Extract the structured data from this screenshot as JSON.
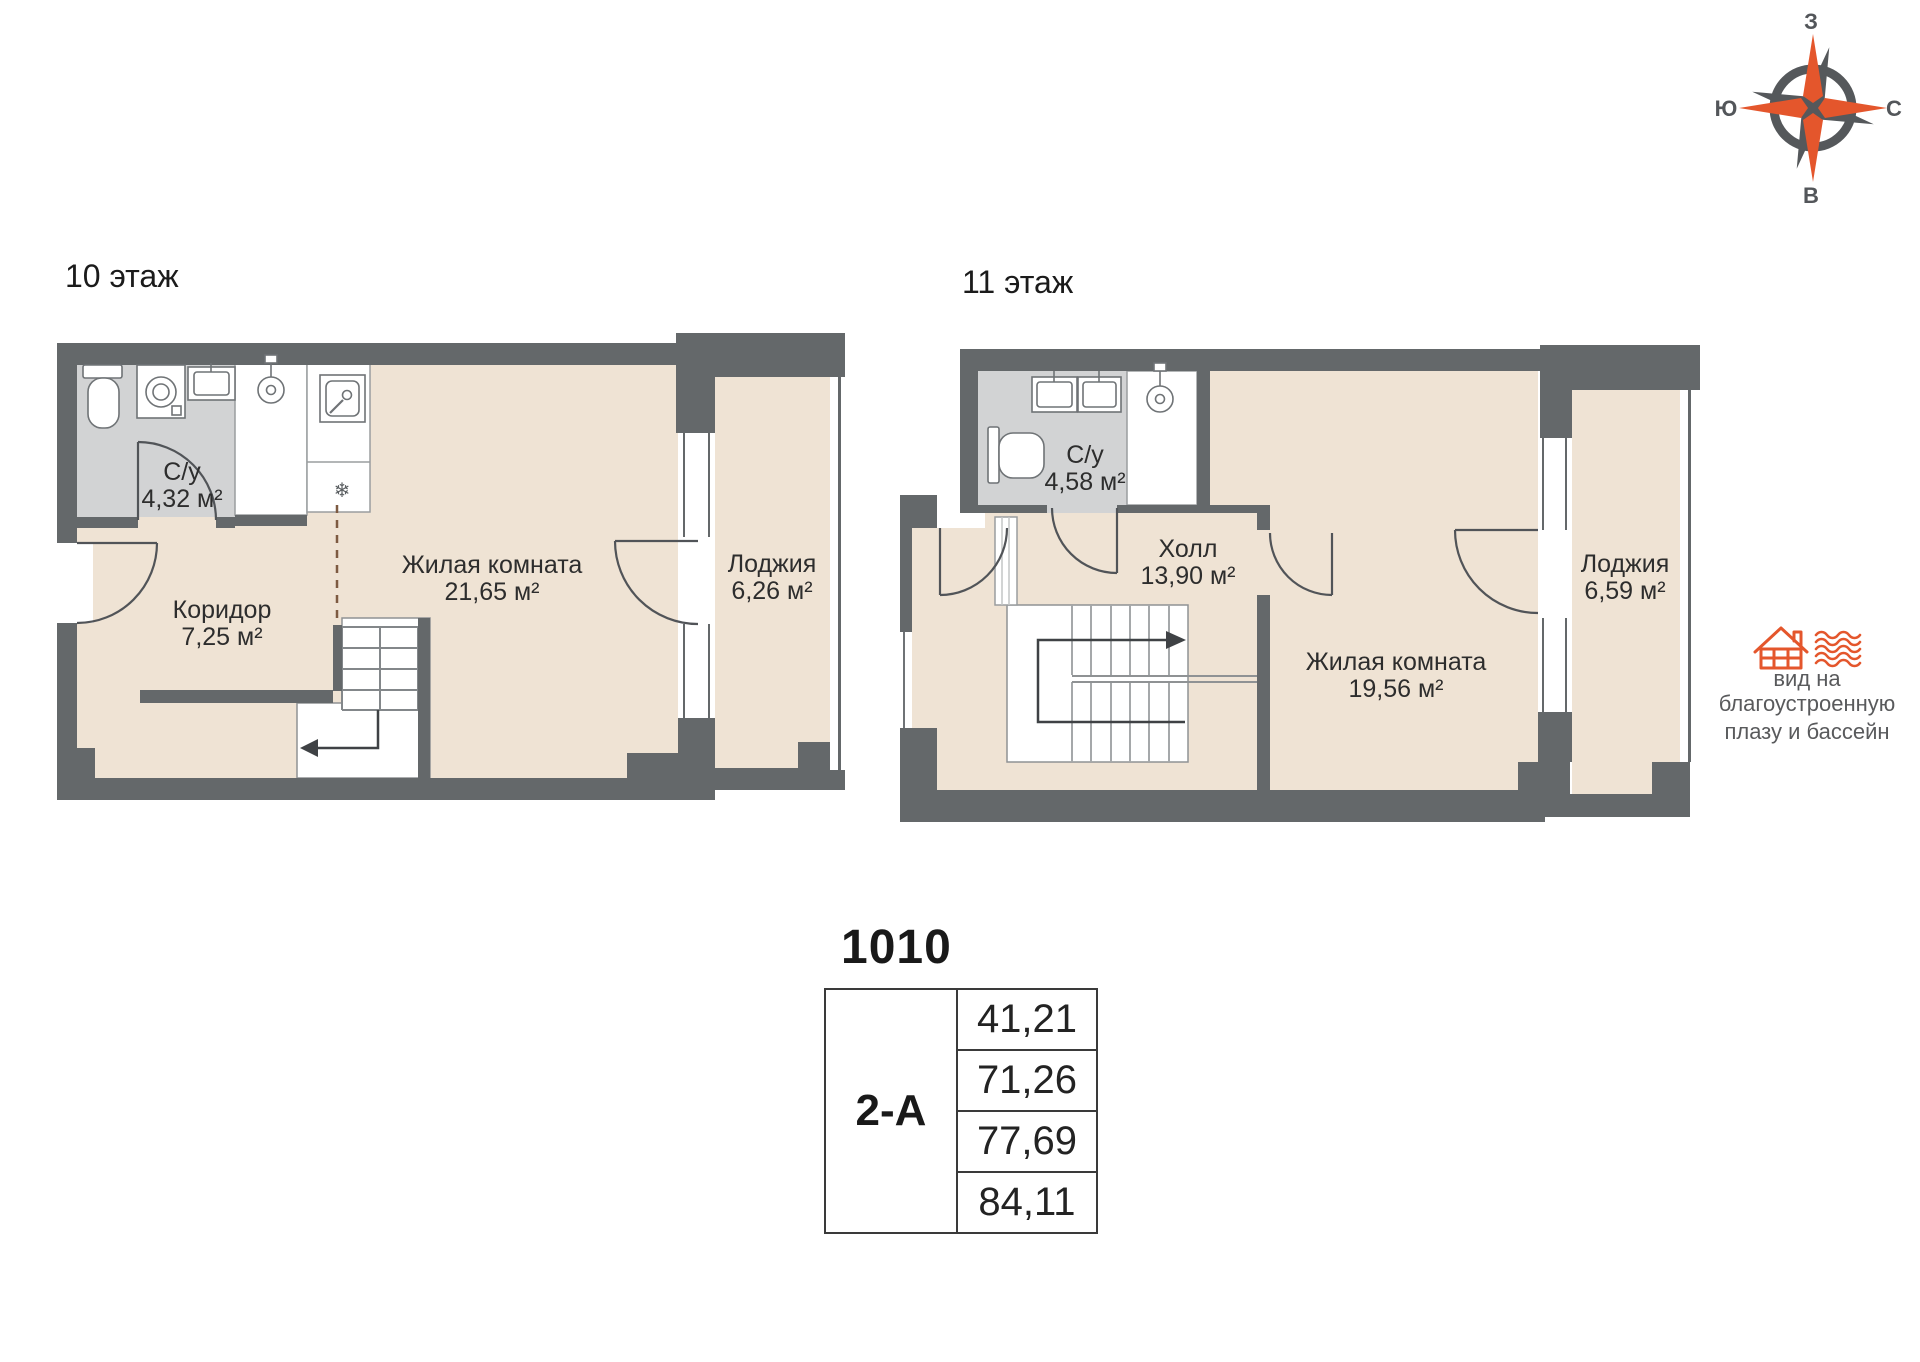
{
  "compass": {
    "top": "З",
    "right": "С",
    "bottom": "В",
    "left": "Ю"
  },
  "floors": [
    {
      "label": "10 этаж",
      "rooms": [
        {
          "name": "С/у",
          "area": "4,32 м²"
        },
        {
          "name": "Коридор",
          "area": "7,25 м²"
        },
        {
          "name": "Жилая комната",
          "area": "21,65 м²"
        },
        {
          "name": "Лоджия",
          "area": "6,26 м²"
        }
      ]
    },
    {
      "label": "11 этаж",
      "rooms": [
        {
          "name": "С/у",
          "area": "4,58 м²"
        },
        {
          "name": "Холл",
          "area": "13,90 м²"
        },
        {
          "name": "Жилая комната",
          "area": "19,56 м²"
        },
        {
          "name": "Лоджия",
          "area": "6,59 м²"
        }
      ]
    }
  ],
  "view_note": {
    "lines": [
      "вид на",
      "благоустроенную",
      "плазу и бассейн"
    ]
  },
  "unit": {
    "number": "1010",
    "layout": "2-А",
    "areas": [
      "41,21",
      "71,26",
      "77,69",
      "84,11"
    ]
  },
  "icons": {
    "snowflake": "❄"
  },
  "colors": {
    "wall": "#64686a",
    "floor": "#efe3d4",
    "wet_floor": "#d2d3d4",
    "accent": "#e4562c"
  }
}
